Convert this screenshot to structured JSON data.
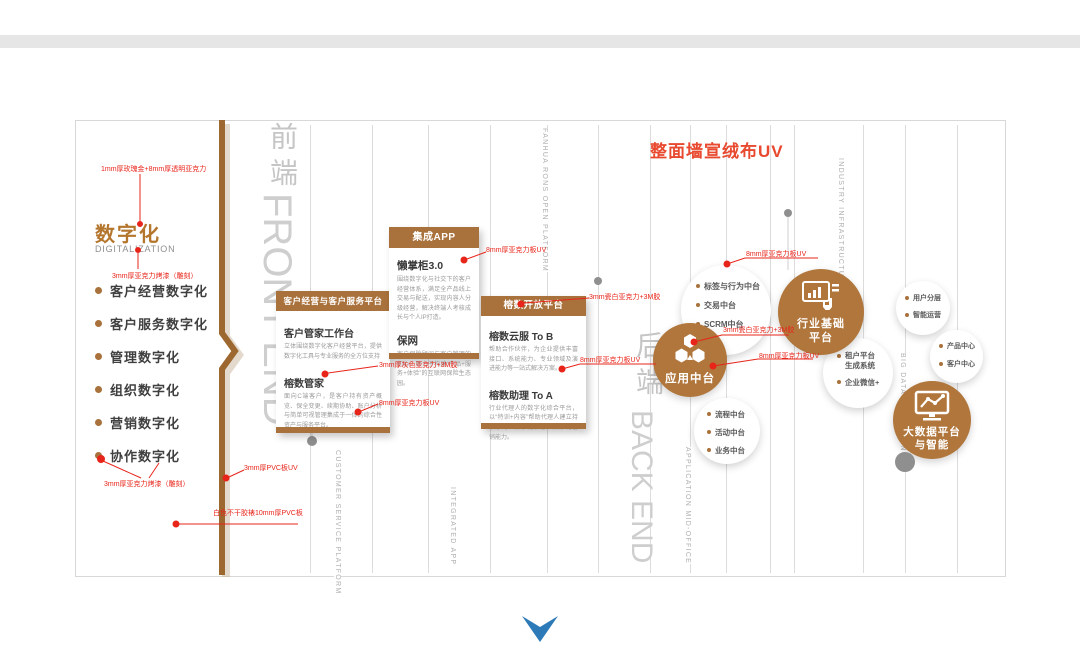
{
  "banner": {
    "wall_note": "整面墙宣绒布UV"
  },
  "digital": {
    "title": "数字化",
    "subtitle": "DIGITALIZATION",
    "items": [
      {
        "label": "客户经营数字化"
      },
      {
        "label": "客户服务数字化"
      },
      {
        "label": "管理数字化"
      },
      {
        "label": "组织数字化"
      },
      {
        "label": "营销数字化"
      },
      {
        "label": "协作数字化"
      }
    ]
  },
  "annotations": {
    "rose_gold": "1mm厚玫瑰金+8mm厚透明亚克力",
    "acrylic_paint_top": "3mm厚亚克力烤漆（雕刻）",
    "acrylic_paint_bottom": "3mm厚亚克力烤漆（雕刻）",
    "pvc_uv": "3mm厚PVC板UV",
    "sticker_pvc": "白色不干胶裱10mm厚PVC板",
    "acrylic_uv_app": "8mm厚亚克力板UV",
    "gray_acrylic": "3mm厚灰色亚克力+3M胶",
    "acrylic_uv_crm": "8mm厚亚克力板UV",
    "white_acrylic_open": "3mm瓷白亚克力+3M胶",
    "acrylic_uv_open": "8mm厚亚克力板UV",
    "acrylic_uv_tags": "8mm厚亚克力板UV",
    "white_acrylic_mid": "3mm瓷白亚克力+3M胶",
    "acrylic_uv_mid": "8mm厚亚克力板UV"
  },
  "watermarks": {
    "front_cn": "前端",
    "front_en": "FRONT END",
    "back_cn": "后端",
    "back_en": "BACK END",
    "fanhua": "FANHUA RONS OPEN PLATFORM",
    "customer": "CUSTOMER SERVICE PLATFORM",
    "integrated": "INTEGRATED APP",
    "application": "APPLICATION MID-OFFICE",
    "industry": "INDUSTRY INFRASTRUCTURE",
    "bigdata": "BIG DATA INTELLIGENCE"
  },
  "cards": {
    "crm": {
      "header": "客户经营与客户服务平台",
      "items": [
        {
          "title": "客户管家工作台",
          "desc": "立体围绕数字化客户经营平台，提供数字化工具与专业服务的全方位支持"
        },
        {
          "title": "榕数管家",
          "desc": "面向C端客户，是客户持有资产概览、保全变更、续期协助、账户分析与简单可视管理集成于一体的综合性资产与服务平台。"
        }
      ]
    },
    "app": {
      "header": "集成APP",
      "items": [
        {
          "title": "懒掌柜3.0",
          "desc": "围绕数字化与社交下的客户经营体系，满足全产品线上交易与配送，实现内容人分级经营，解决终端人考核成长与个人IP打造。"
        },
        {
          "title": "保网",
          "desc": "客户保险顾问与客户管理的初心，致力于构建“产品+服务+体验”的互联网保险生态园。"
        }
      ]
    },
    "open": {
      "header": "榕数开放平台",
      "items": [
        {
          "title": "榕数云服 To B",
          "desc": "帮助合作伙伴，为企业提供丰富接口、系统能力、专业领域及演进能力等一站式解决方案。"
        },
        {
          "title": "榕数助理 To A",
          "desc": "行业代理人的数字化综合平台，以“特训+内容”帮助代理人建立持续学习、数字化获客、数字化营销能力。"
        }
      ]
    }
  },
  "circles": {
    "tags": {
      "items": [
        "标签与行为中台",
        "交易中台",
        "SCRM中台"
      ]
    },
    "app_mid": {
      "label": "应用中台"
    },
    "process": {
      "items": [
        "流程中台",
        "活动中台",
        "业务中台"
      ]
    },
    "industry": {
      "label_line1": "行业基础",
      "label_line2": "平台"
    },
    "tenant": {
      "items": [
        "租户平台生成系统",
        "企业微信+"
      ]
    },
    "user": {
      "items": [
        "用户分层",
        "智能运营"
      ]
    },
    "product": {
      "items": [
        "产品中心",
        "客户中心"
      ]
    },
    "bigdata": {
      "label_line1": "大数据平台",
      "label_line2": "与智能"
    }
  },
  "colors": {
    "accent_brown": "#a9713b",
    "circle_brown": "#b0763b",
    "annotation_red": "#e8251a",
    "wall_note_red": "#e8492f",
    "watermark_gray": "#cbcbcb",
    "chevron_blue": "#2d7ab8"
  }
}
